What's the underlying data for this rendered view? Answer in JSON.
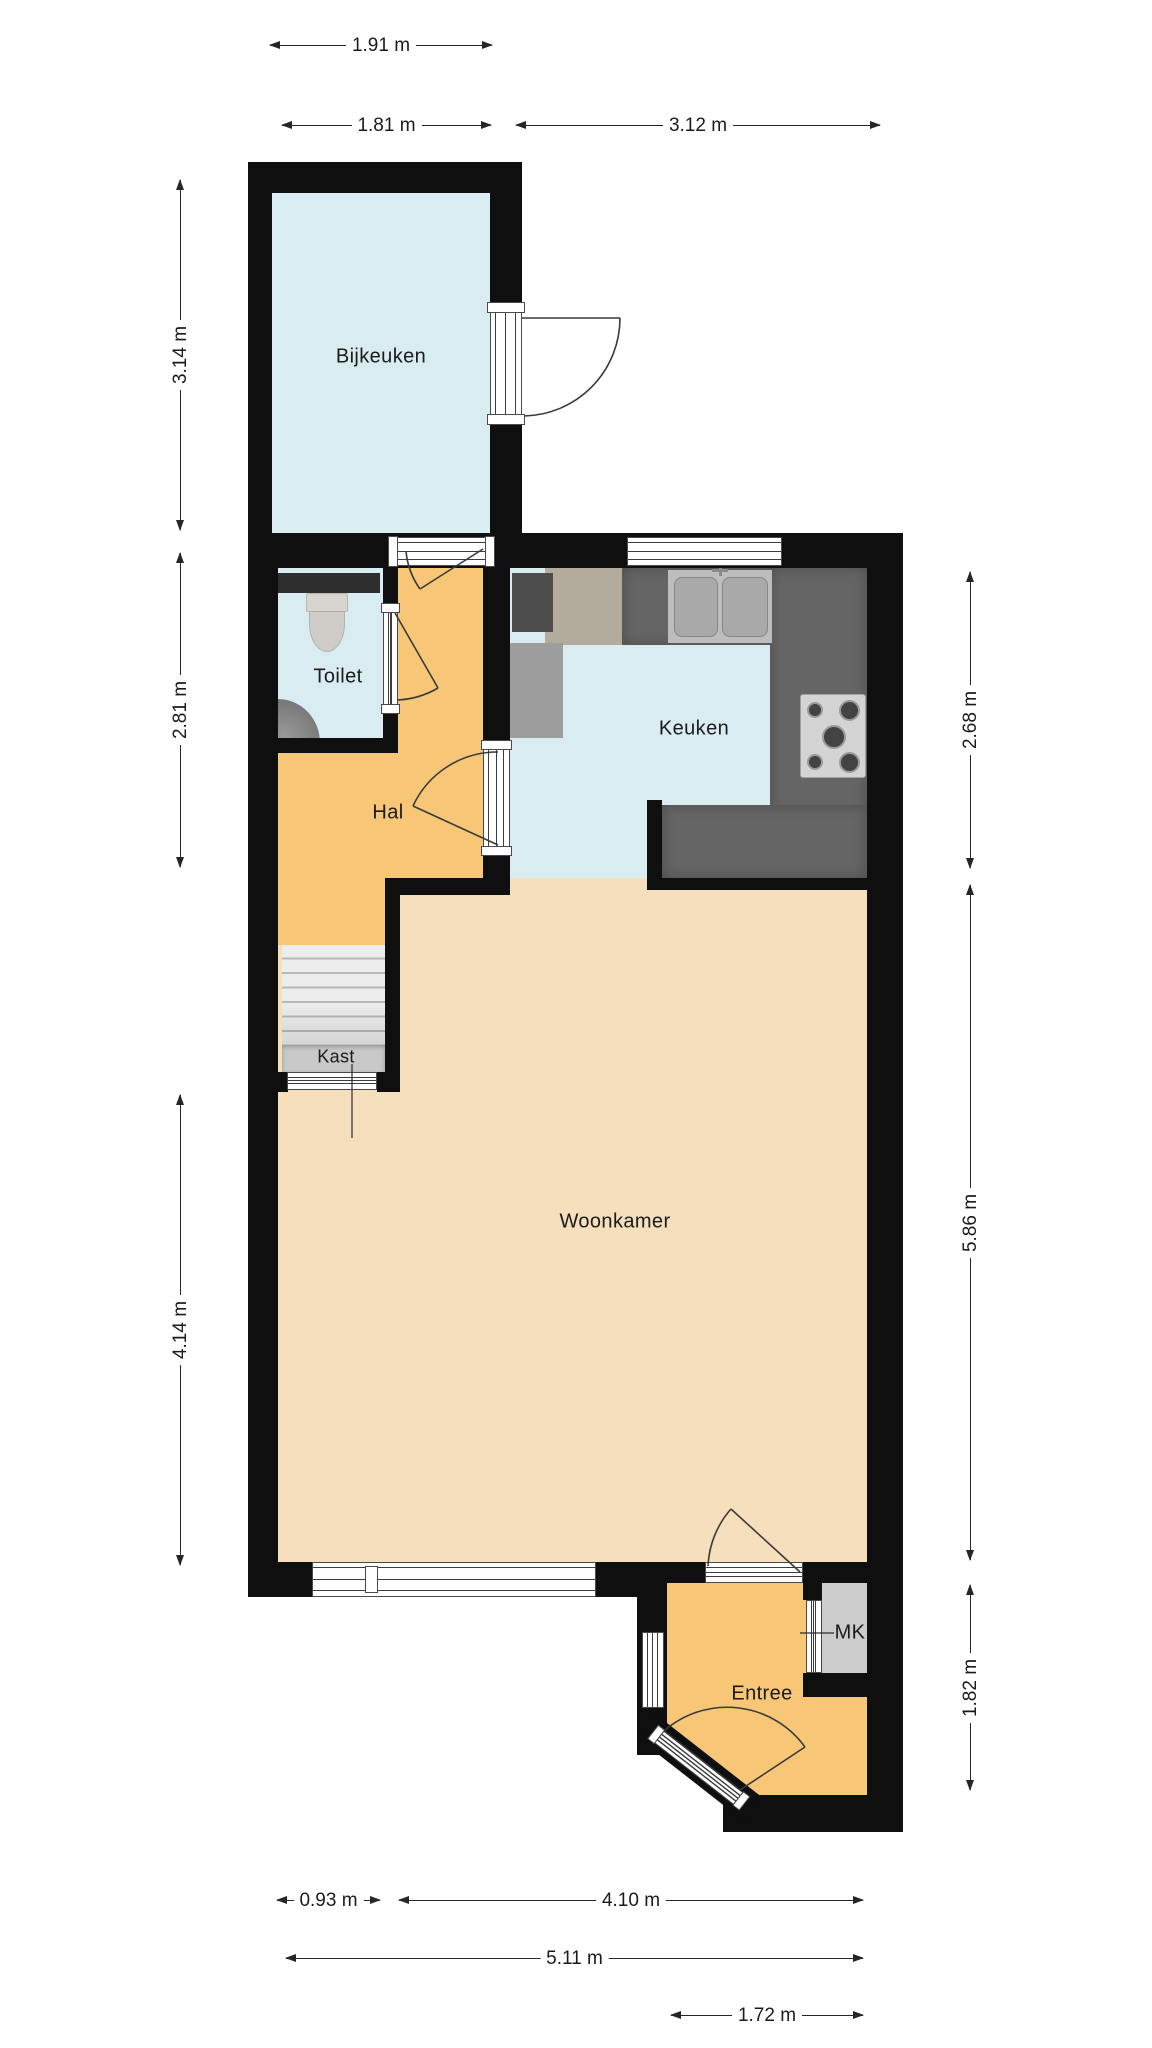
{
  "rooms": {
    "bijkeuken": {
      "label": "Bijkeuken"
    },
    "toilet": {
      "label": "Toilet"
    },
    "hal": {
      "label": "Hal"
    },
    "keuken": {
      "label": "Keuken"
    },
    "woonkamer": {
      "label": "Woonkamer"
    },
    "kast": {
      "label": "Kast"
    },
    "entree": {
      "label": "Entree"
    },
    "mk": {
      "label": "MK"
    }
  },
  "dimensions": {
    "top": [
      {
        "label": "1.91 m"
      },
      {
        "label": "1.81 m"
      },
      {
        "label": "3.12 m"
      }
    ],
    "left": [
      {
        "label": "3.14 m"
      },
      {
        "label": "2.81 m"
      },
      {
        "label": "4.14 m"
      }
    ],
    "right": [
      {
        "label": "2.68 m"
      },
      {
        "label": "5.86 m"
      },
      {
        "label": "1.82 m"
      }
    ],
    "bottom": [
      {
        "label": "0.93 m"
      },
      {
        "label": "4.10 m"
      },
      {
        "label": "5.11 m"
      },
      {
        "label": "1.72 m"
      }
    ]
  },
  "colors": {
    "wall": "#0f0f0f",
    "wet_room_floor": "#d9ecf2",
    "hall_floor": "#f7c676",
    "living_floor": "#f5dfbd",
    "counter": "#656565",
    "cabinet": "#b3ab9c",
    "closet": "#c9c9c9",
    "meter_cupboard": "#cccccc"
  }
}
